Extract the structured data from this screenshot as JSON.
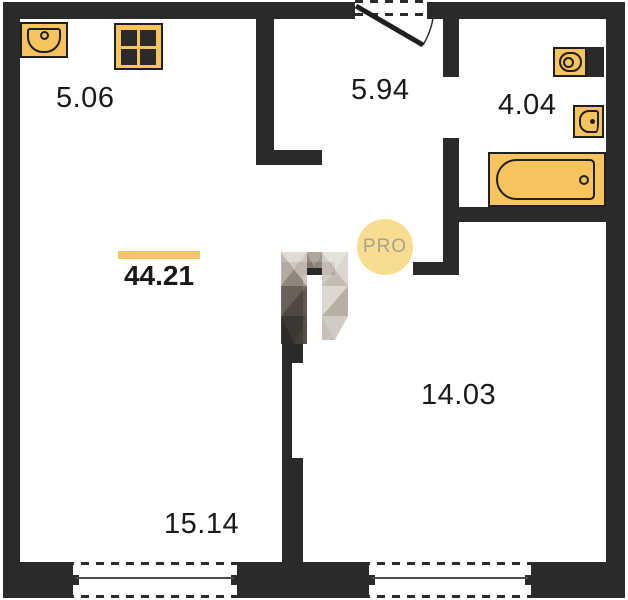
{
  "floorplan": {
    "title": "apartment floor plan",
    "total_area_label": "44.21",
    "rooms": [
      {
        "name": "kitchen",
        "area_label": "5.06"
      },
      {
        "name": "hallway",
        "area_label": "5.94"
      },
      {
        "name": "bathroom",
        "area_label": "4.04"
      },
      {
        "name": "bedroom",
        "area_label": "14.03"
      },
      {
        "name": "living-room",
        "area_label": "15.14"
      }
    ],
    "watermark": {
      "badge_text": "PRO"
    },
    "fixtures": [
      "kitchen-sink",
      "stove",
      "toilet",
      "washbasin",
      "bathtub"
    ],
    "openings": [
      "entrance-door",
      "bathroom-door",
      "left-window",
      "right-window"
    ],
    "colors": {
      "wall": "#2b2a28",
      "fixture_fill": "#f6c35c",
      "fixture_outline": "#1f1f1f",
      "area_underline": "#f5c464",
      "watermark_circle_fill": "#f8dc8d",
      "watermark_text": "#a7a193",
      "label_text": "#191919",
      "background": "#ffffff"
    }
  }
}
